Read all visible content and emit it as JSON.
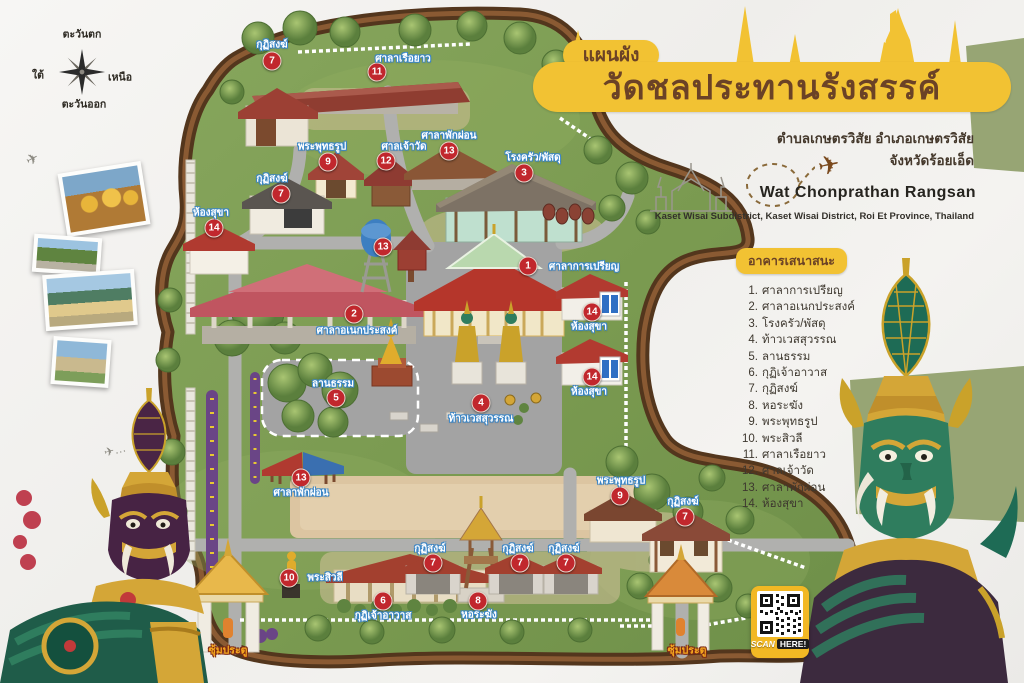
{
  "poster": {
    "title_small": "แผนผัง",
    "title_main": "วัดชลประทานรังสรรค์",
    "subtitle1": "ตำบลเกษตรวิสัย อำเภอเกษตรวิสัย",
    "subtitle2": "จังหวัดร้อยเอ็ด",
    "title_en": "Wat Chonprathan Rangsan",
    "title_en_sub": "Kaset Wisai Subdistrict, Kaset Wisai District, Roi Et Province, Thailand"
  },
  "compass": {
    "top": "ตะวันตก",
    "right": "เหนือ",
    "bottom": "ตะวันออก",
    "left": "ใต้"
  },
  "legend": {
    "header": "อาคารเสนาสนะ",
    "items": [
      "ศาลาการเปรียญ",
      "ศาลาอเนกประสงค์",
      "โรงครัว/พัสดุ",
      "ท้าวเวสสุวรรณ",
      "ลานธรรม",
      "กุฏิเจ้าอาวาส",
      "กุฏิสงฆ์",
      "หอระฆัง",
      "พระพุทธรูป",
      "พระสิวลี",
      "ศาลาเรือยาว",
      "ศาลเจ้าวัด",
      "ศาลาพักผ่อน",
      "ห้องสุขา"
    ]
  },
  "map": {
    "markers": [
      {
        "num": "7",
        "label": "กุฏิสงฆ์",
        "x": 272,
        "y": 61,
        "lx": 272,
        "ly": 45
      },
      {
        "num": "11",
        "label": "ศาลาเรือยาว",
        "x": 377,
        "y": 72,
        "lx": 403,
        "ly": 59
      },
      {
        "num": "9",
        "label": "พระพุทธรูป",
        "x": 328,
        "y": 162,
        "lx": 322,
        "ly": 147
      },
      {
        "num": "12",
        "label": "ศาลเจ้าวัด",
        "x": 386,
        "y": 161,
        "lx": 404,
        "ly": 147
      },
      {
        "num": "13",
        "label": "ศาลาพักผ่อน",
        "x": 449,
        "y": 151,
        "lx": 449,
        "ly": 136
      },
      {
        "num": "3",
        "label": "โรงครัว/พัสดุ",
        "x": 524,
        "y": 173,
        "lx": 533,
        "ly": 158
      },
      {
        "num": "7",
        "label": "กุฏิสงฆ์",
        "x": 281,
        "y": 194,
        "lx": 272,
        "ly": 179
      },
      {
        "num": "14",
        "label": "ห้องสุขา",
        "x": 214,
        "y": 228,
        "lx": 211,
        "ly": 213
      },
      {
        "num": "13",
        "label": "",
        "x": 383,
        "y": 247,
        "lx": 0,
        "ly": 0
      },
      {
        "num": "2",
        "label": "ศาลาอเนกประสงค์",
        "x": 354,
        "y": 314,
        "lx": 357,
        "ly": 331
      },
      {
        "num": "1",
        "label": "ศาลาการเปรียญ",
        "x": 528,
        "y": 266,
        "lx": 584,
        "ly": 267
      },
      {
        "num": "14",
        "label": "ห้องสุขา",
        "x": 592,
        "y": 312,
        "lx": 589,
        "ly": 327
      },
      {
        "num": "14",
        "label": "ห้องสุขา",
        "x": 592,
        "y": 377,
        "lx": 589,
        "ly": 392
      },
      {
        "num": "4",
        "label": "ท้าวเวสสุวรรณ",
        "x": 481,
        "y": 403,
        "lx": 481,
        "ly": 419
      },
      {
        "num": "5",
        "label": "ลานธรรม",
        "x": 336,
        "y": 398,
        "lx": 333,
        "ly": 384
      },
      {
        "num": "13",
        "label": "ศาลาพักผ่อน",
        "x": 301,
        "y": 478,
        "lx": 301,
        "ly": 493
      },
      {
        "num": "9",
        "label": "พระพุทธรูป",
        "x": 620,
        "y": 496,
        "lx": 621,
        "ly": 481
      },
      {
        "num": "7",
        "label": "กุฏิสงฆ์",
        "x": 685,
        "y": 517,
        "lx": 683,
        "ly": 502
      },
      {
        "num": "10",
        "label": "พระสิวลี",
        "x": 289,
        "y": 578,
        "lx": 325,
        "ly": 578
      },
      {
        "num": "6",
        "label": "กุฏิเจ้าอาวาส",
        "x": 383,
        "y": 601,
        "lx": 383,
        "ly": 616
      },
      {
        "num": "8",
        "label": "หอระฆัง",
        "x": 478,
        "y": 601,
        "lx": 479,
        "ly": 615
      },
      {
        "num": "7",
        "label": "กุฏิสงฆ์",
        "x": 433,
        "y": 563,
        "lx": 430,
        "ly": 549
      },
      {
        "num": "7",
        "label": "กุฏิสงฆ์",
        "x": 520,
        "y": 563,
        "lx": 518,
        "ly": 549
      },
      {
        "num": "7",
        "label": "กุฏิสงฆ์",
        "x": 566,
        "y": 563,
        "lx": 564,
        "ly": 549
      }
    ],
    "gates": [
      {
        "label": "ซุ้มประตู",
        "lx": 228,
        "ly": 650
      },
      {
        "label": "ซุ้มประตู",
        "lx": 687,
        "ly": 650
      }
    ],
    "photos": [
      "buddha-statues",
      "temple-grounds",
      "temple-pavilion",
      "temple-gate"
    ]
  },
  "qr": {
    "scan": "SCAN",
    "here": "HERE!"
  },
  "colors": {
    "accent_yellow": "#F2C233",
    "title_brown": "#6B4226",
    "marker_red": "#C1272D",
    "label_outline_blue": "#3A86C8",
    "map_green": "#7E9E53",
    "border_brown": "#53361D",
    "road_gray": "#B0B0AE",
    "gate_label_orange": "#F6A71E"
  }
}
